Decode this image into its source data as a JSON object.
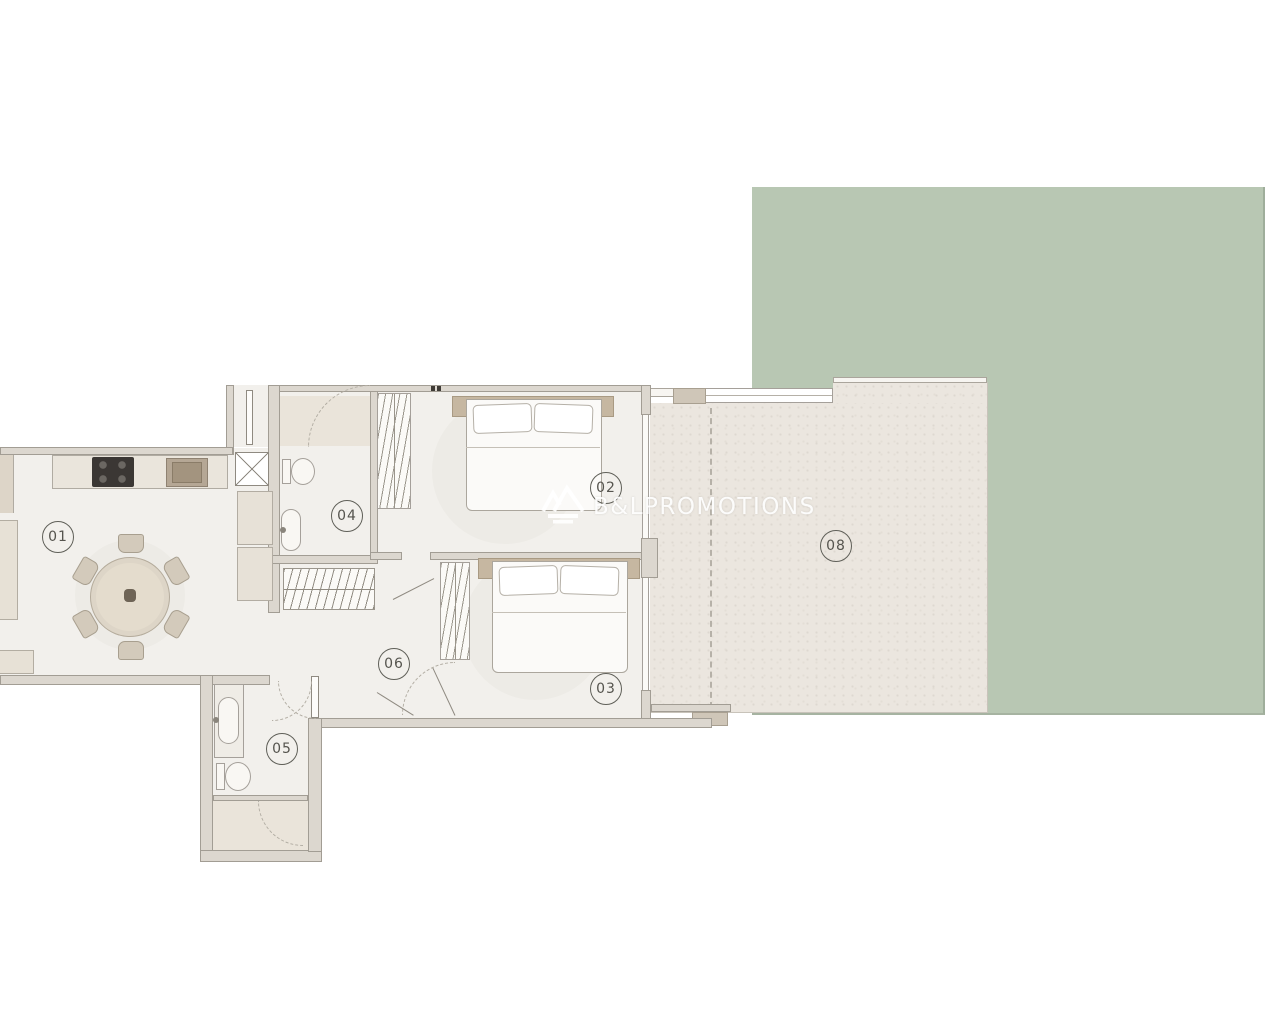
{
  "floorplan": {
    "watermark": {
      "text": "B&LPROMOTIONS"
    },
    "rooms": [
      {
        "name": "living-dining-kitchen",
        "label": "01"
      },
      {
        "name": "bedroom-main",
        "label": "02"
      },
      {
        "name": "bedroom-second",
        "label": "03"
      },
      {
        "name": "bathroom-main",
        "label": "04"
      },
      {
        "name": "bathroom-second",
        "label": "05"
      },
      {
        "name": "hallway",
        "label": "06"
      },
      {
        "name": "terrace",
        "label": "08"
      }
    ],
    "colors": {
      "garden": "#b8c7b3",
      "terrace": "#ebe6df",
      "wall_fill": "#dcd7cf",
      "wall_line": "#a29d94",
      "floor": "#f2f0ec",
      "furniture": "#d3cabb",
      "headboard": "#c6b7a1",
      "cooktop": "#3b3734",
      "label_ink": "#55544e"
    }
  }
}
